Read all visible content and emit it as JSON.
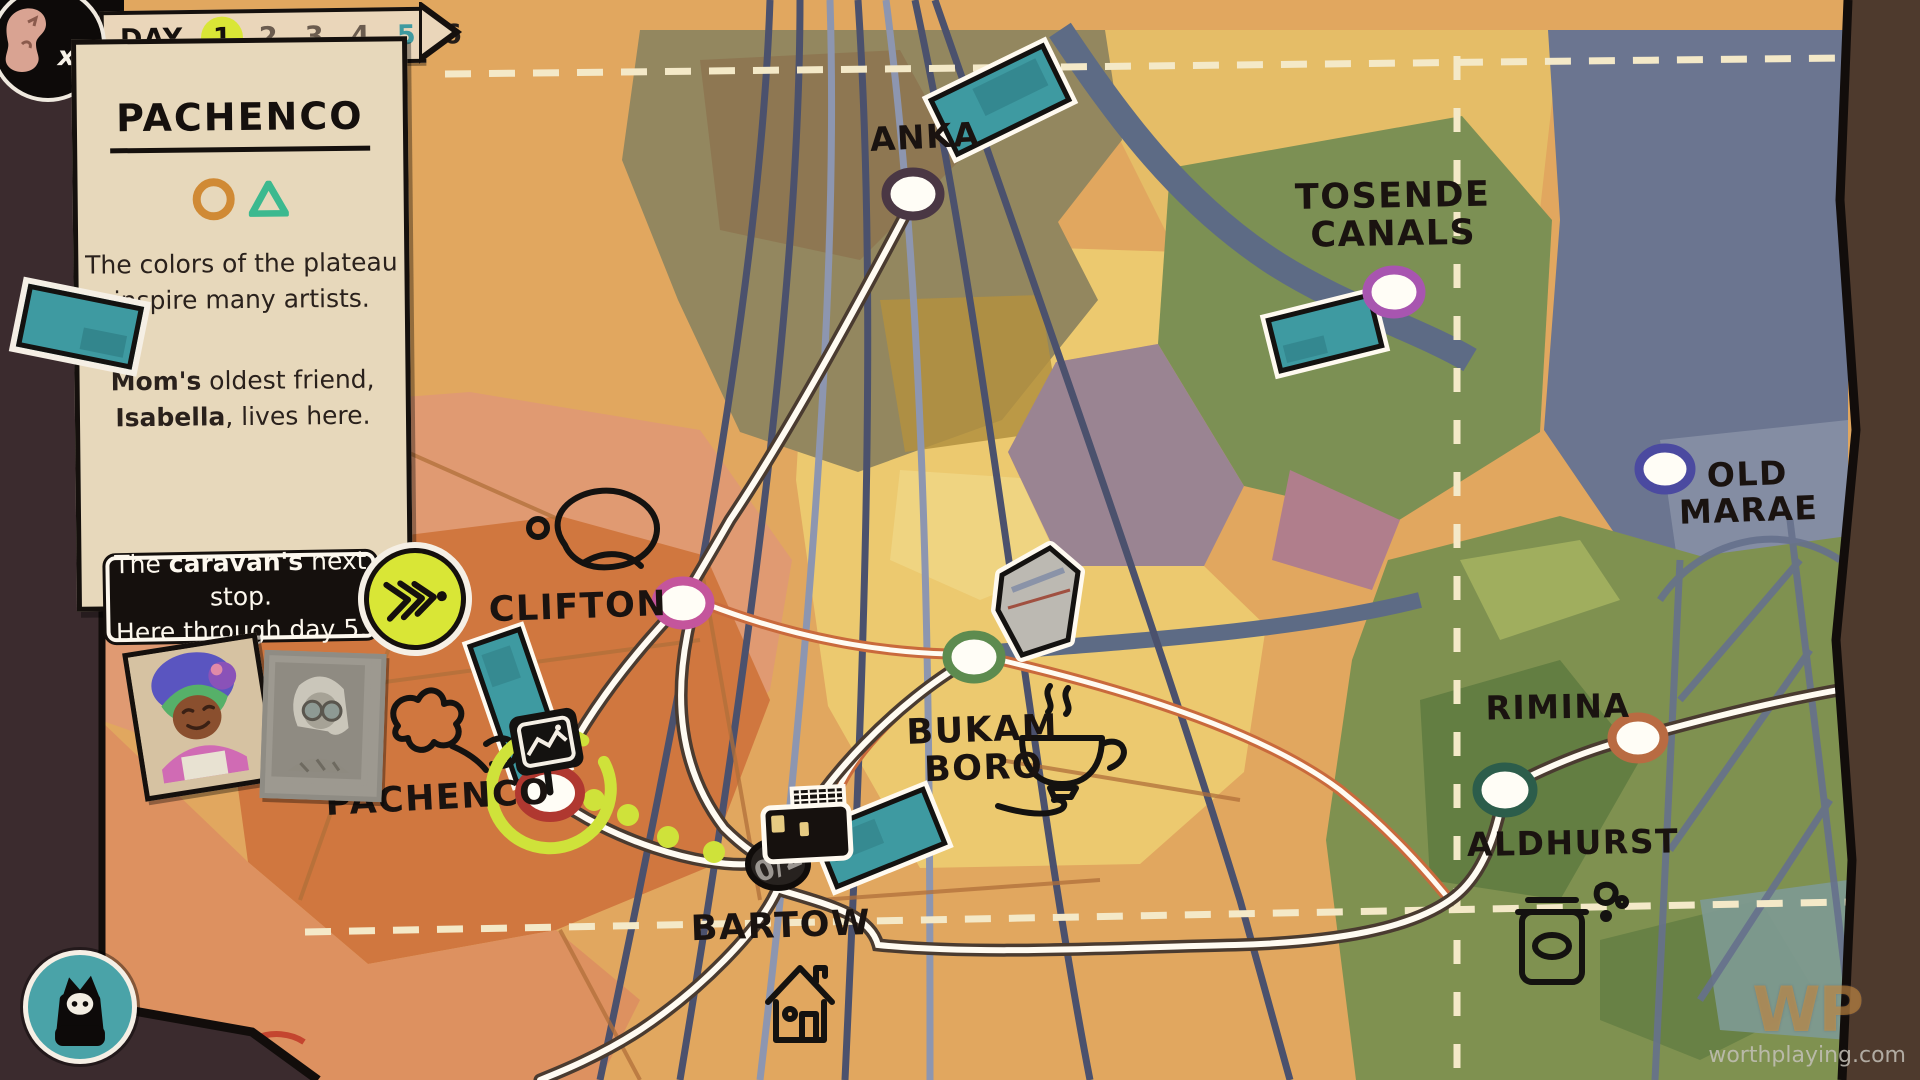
{
  "hud": {
    "badge": {
      "count": "x0"
    },
    "day_tracker": {
      "label": "DAY",
      "days": [
        "1",
        "2",
        "3",
        "4",
        "5",
        "6"
      ],
      "current_day": "1",
      "departure_day": "5"
    },
    "panel": {
      "title": "PACHENCO",
      "traits": [
        "circle",
        "triangle"
      ],
      "description_line1": "The colors of the plateau",
      "description_line2": "inspire many artists.",
      "note_bold1": "Mom's",
      "note_rest1": " oldest friend,",
      "note_bold2": "Isabella",
      "note_rest2": ", lives here."
    },
    "tooltip": {
      "pre": "The ",
      "bold": "caravan's",
      "post": " next stop.",
      "line2": "Here through day 5."
    },
    "watermark": {
      "logo": "WP",
      "site": "worthplaying.com"
    }
  },
  "map": {
    "towns": [
      {
        "name": "anka",
        "label": "ANKA",
        "ring": "#4a3744"
      },
      {
        "name": "tosende-canals",
        "label1": "TOSENDE",
        "label2": "CANALS",
        "ring": "#a855b0"
      },
      {
        "name": "old-marae",
        "label1": "OLD",
        "label2": "MARAE",
        "ring": "#4b4aa0"
      },
      {
        "name": "clifton",
        "label": "CLIFTON",
        "ring": "#c4559c"
      },
      {
        "name": "bukam-boro",
        "label1": "BUKAM",
        "label2": "BORO",
        "ring": "#5d8b4f"
      },
      {
        "name": "pachenco",
        "label": "PACHENCO",
        "ring": "#b03830",
        "highlighted": true
      },
      {
        "name": "bartow",
        "label": "BARTOW",
        "counter": "0/2",
        "caravan_here": true
      },
      {
        "name": "rimina",
        "label": "RIMINA",
        "ring": "#b96b42"
      },
      {
        "name": "aldhurst",
        "label": "ALDHURST",
        "ring": "#2c5d4b"
      }
    ],
    "colors": {
      "accent_yellow_green": "#d9e636",
      "postcard_teal": "#3e9aa1",
      "route_white": "#fffbf2",
      "route_orange": "#c96a3c",
      "paper": "#e7d8bb",
      "ink": "#15100d"
    }
  }
}
